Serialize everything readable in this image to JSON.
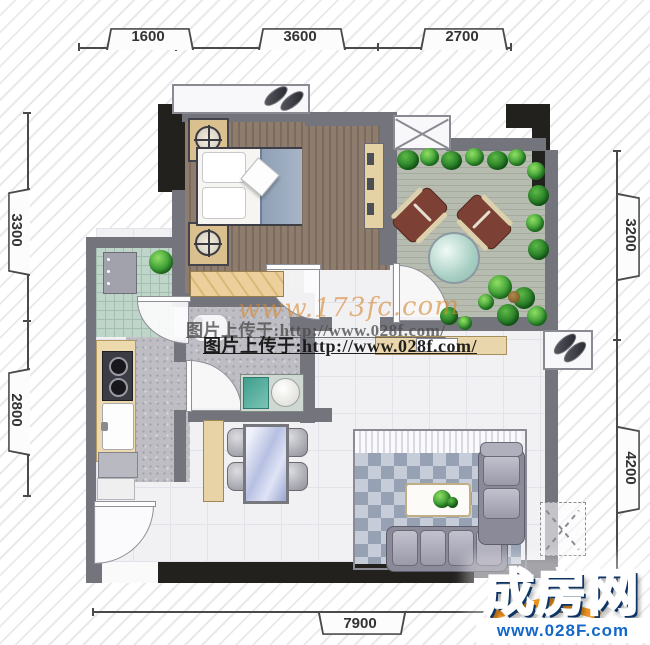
{
  "dimensions": {
    "top": [
      "1600",
      "3600",
      "2700"
    ],
    "left": [
      "3300",
      "2800"
    ],
    "right": [
      "3200",
      "4200"
    ],
    "bottom": [
      "7900"
    ]
  },
  "watermarks": {
    "site": "www.173fc.com",
    "upload_gray": "图片上传于:http://www.028f.com/",
    "upload_black": "图片上传于:http://www.028f.com/"
  },
  "logo": {
    "brand": "成房网",
    "url": "www.028F.com"
  },
  "colors": {
    "wall_gray": "#74747c",
    "wall_black": "#23211e",
    "bedroom_floor": "#8e7d6e",
    "terrace_deck": "#b7bcb0",
    "kitchen_tile": "#bfd5c9",
    "rug_dark": "#96a1b3",
    "rug_light": "#c6ccd8",
    "plant_green": "#3a9a33",
    "lounge_brown": "#7c4034",
    "logo_blue": "#1565c5",
    "logo_orange": "#ef9320",
    "watermark_orange": "#d68830"
  }
}
